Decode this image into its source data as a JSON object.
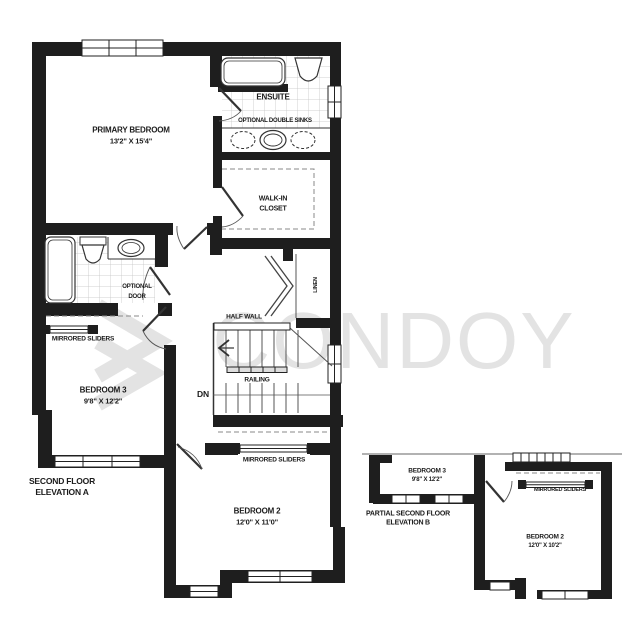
{
  "watermark": {
    "text": "CONDOY",
    "color": "#e3e3e3"
  },
  "plan_a": {
    "title_line1": "SECOND FLOOR",
    "title_line2": "ELEVATION A",
    "rooms": {
      "primary_bedroom": {
        "name": "PRIMARY BEDROOM",
        "dims": "13'2\" X 15'4\""
      },
      "ensuite": {
        "name": "ENSUITE"
      },
      "walk_in_closet": {
        "name_line1": "WALK-IN",
        "name_line2": "CLOSET"
      },
      "bedroom3": {
        "name": "BEDROOM 3",
        "dims": "9'8\" X 12'2\""
      },
      "bedroom2": {
        "name": "BEDROOM 2",
        "dims": "12'0\" X 11'0\""
      },
      "linen": {
        "name": "LINEN"
      }
    },
    "annotations": {
      "optional_double_sinks": "OPTIONAL DOUBLE SINKS",
      "optional_door_line1": "OPTIONAL",
      "optional_door_line2": "DOOR",
      "mirrored_sliders_bath": "MIRRORED SLIDERS",
      "mirrored_sliders_bedroom2": "MIRRORED SLIDERS",
      "half_wall": "HALF WALL",
      "railing": "RAILING",
      "down": "DN"
    }
  },
  "plan_b": {
    "title_line1": "PARTIAL SECOND FLOOR",
    "title_line2": "ELEVATION B",
    "rooms": {
      "bedroom3": {
        "name": "BEDROOM 3",
        "dims": "9'8\" X 12'2\""
      },
      "bedroom2": {
        "name": "BEDROOM 2",
        "dims": "12'0\" X 10'2\""
      }
    },
    "annotations": {
      "mirrored_sliders": "MIRRORED SLIDERS"
    }
  }
}
